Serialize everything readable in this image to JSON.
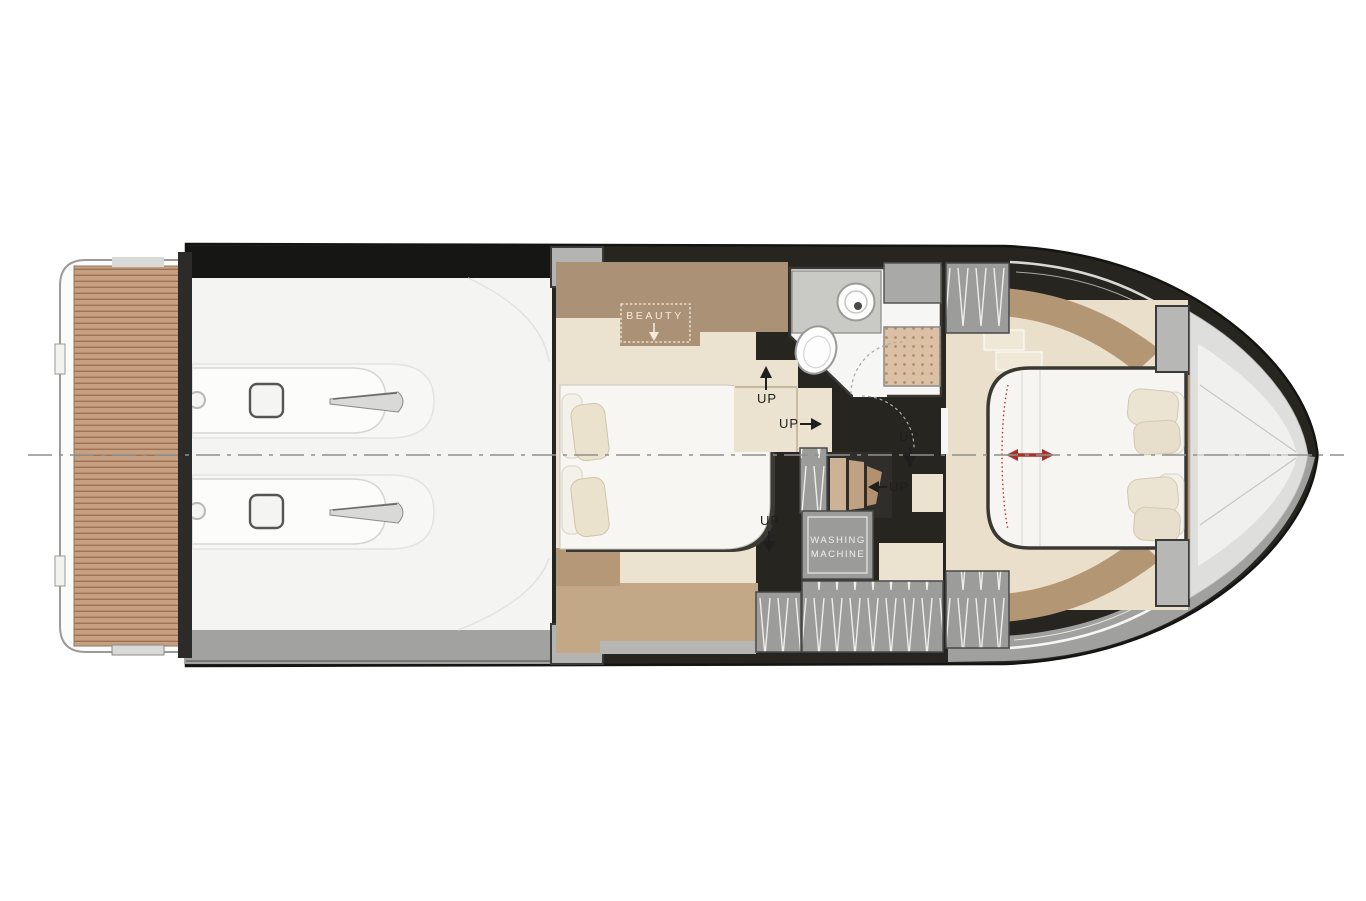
{
  "plan": {
    "labels": {
      "beauty": "BEAUTY",
      "up": "UP",
      "washing_line1": "WASHING",
      "washing_line2": "MACHINE"
    },
    "colors": {
      "hull_dark": "#26251f",
      "gray_band": "#a2a2a0",
      "teak": "#c79f81",
      "wood": "#ab9175",
      "wood_light": "#c3a888",
      "floor_beige": "#ebe2d0",
      "bed_white": "#f7f6f2",
      "pillow_cream": "#eae2cd",
      "locker_gray": "#9c9c9a",
      "shower_tile": "#dcc0a5",
      "accent_red": "#a8322a",
      "centerline_gray": "#8f8f8d",
      "label_dark": "#1f1f1d",
      "label_light": "#f3ecdc"
    }
  }
}
